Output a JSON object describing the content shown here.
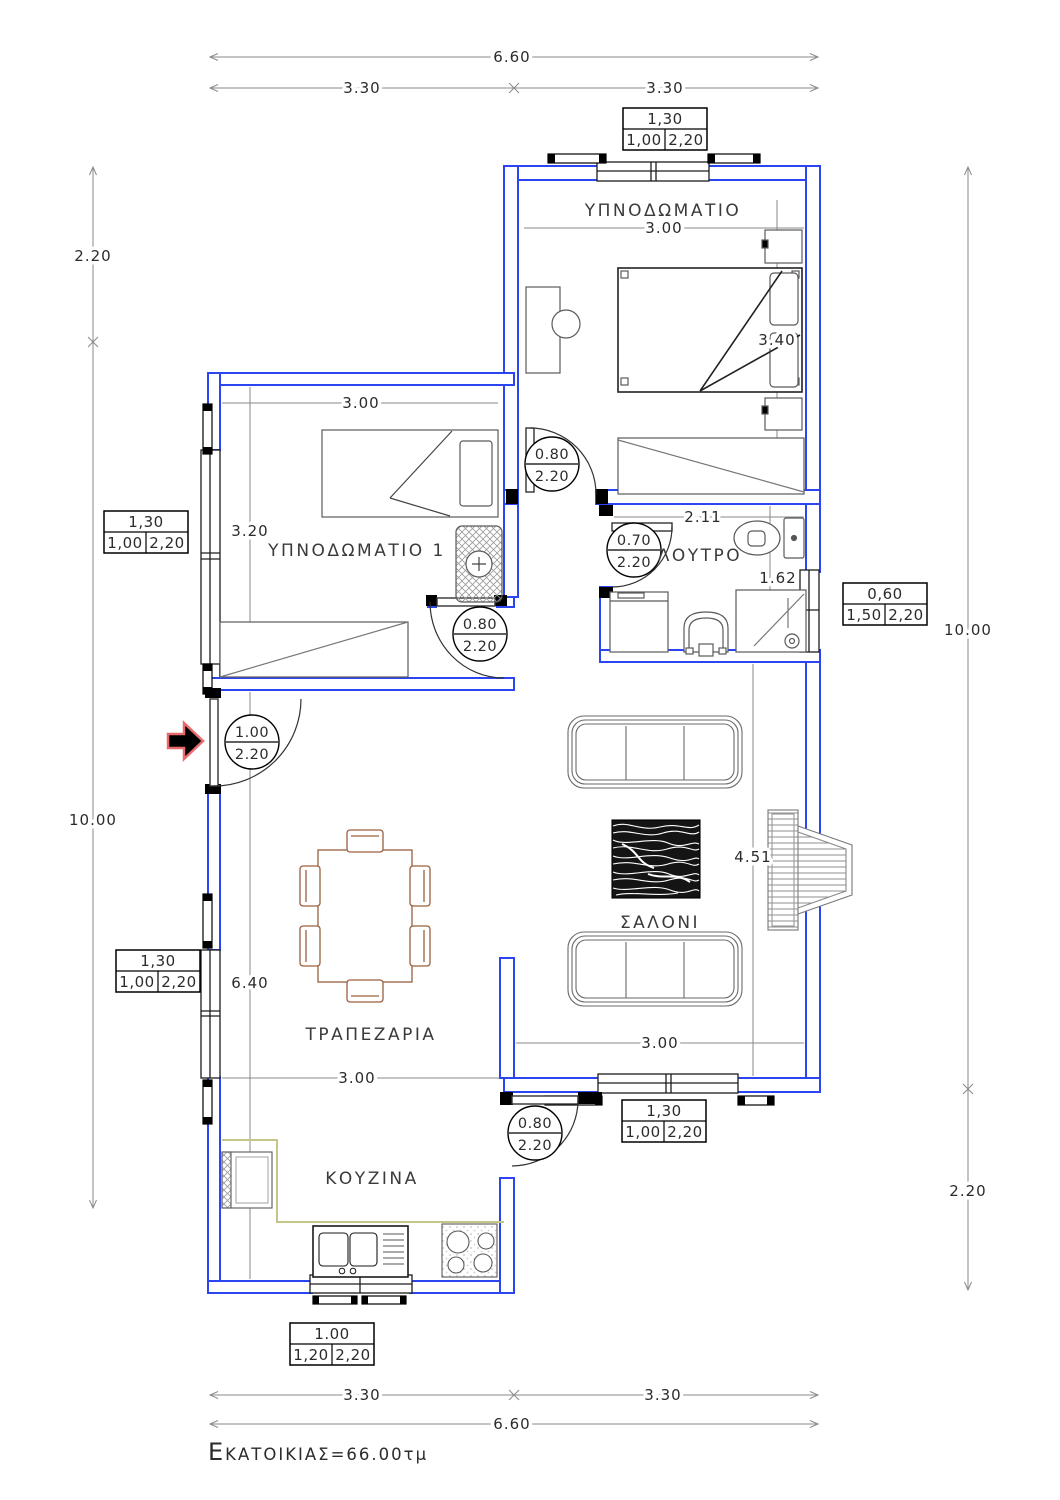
{
  "area": {
    "initial": "Ε",
    "rest": "ΚΑΤΟΙΚΙΑΣ=66.00τμ"
  },
  "rooms": {
    "bedroom": "ΥΠΝΟΔΩΜΑΤΙΟ",
    "bedroom1": "ΥΠΝΟΔΩΜΑΤΙΟ 1",
    "bathroom": "ΛΟΥΤΡΟ",
    "living": "ΣΑΛΟΝΙ",
    "dining": "ΤΡΑΠΕΖΑΡΙΑ",
    "kitchen": "ΚΟΥΖΙΝΑ"
  },
  "dims": {
    "top_overall": "6.60",
    "top_left": "3.30",
    "top_right": "3.30",
    "bottom_left": "3.30",
    "bottom_right": "3.30",
    "bottom_overall": "6.60",
    "left_upper": "2.20",
    "left_main": "10.00",
    "right_main": "10.00",
    "right_lower": "2.20",
    "bedroom_width": "3.00",
    "bedroom_depth": "3.40",
    "bedroom1_width": "3.00",
    "bedroom1_depth": "3.20",
    "bathroom_width": "2.11",
    "bathroom_depth": "1.62",
    "living_depth": "4.51",
    "living_width": "3.00",
    "dining_depth": "6.40",
    "dining_width": "3.00"
  },
  "doors": {
    "entrance": {
      "w": "1.00",
      "h": "2.20"
    },
    "bedroom1": {
      "w": "0.80",
      "h": "2.20"
    },
    "bedroom": {
      "w": "0.80",
      "h": "2.20"
    },
    "bathroom": {
      "w": "0.70",
      "h": "2.20"
    },
    "kitchen": {
      "w": "0.80",
      "h": "2.20"
    }
  },
  "windows": {
    "top": {
      "w": "1,30",
      "a": "1,00",
      "b": "2,20"
    },
    "left1": {
      "w": "1,30",
      "a": "1,00",
      "b": "2,20"
    },
    "left2": {
      "w": "1,30",
      "a": "1,00",
      "b": "2,20"
    },
    "right": {
      "w": "0,60",
      "a": "1,50",
      "b": "2,20"
    },
    "living": {
      "w": "1,30",
      "a": "1,00",
      "b": "2,20"
    },
    "kitchen": {
      "w": "1.00",
      "a": "1,20",
      "b": "2,20"
    }
  },
  "colors": {
    "wall": "#2b45f2",
    "dimline": "#8a8a8a",
    "furniture": "#5a5a5a",
    "wood": "#9c5f3f",
    "counter": "#c5c489",
    "arrow_outline": "#e86a6a"
  }
}
